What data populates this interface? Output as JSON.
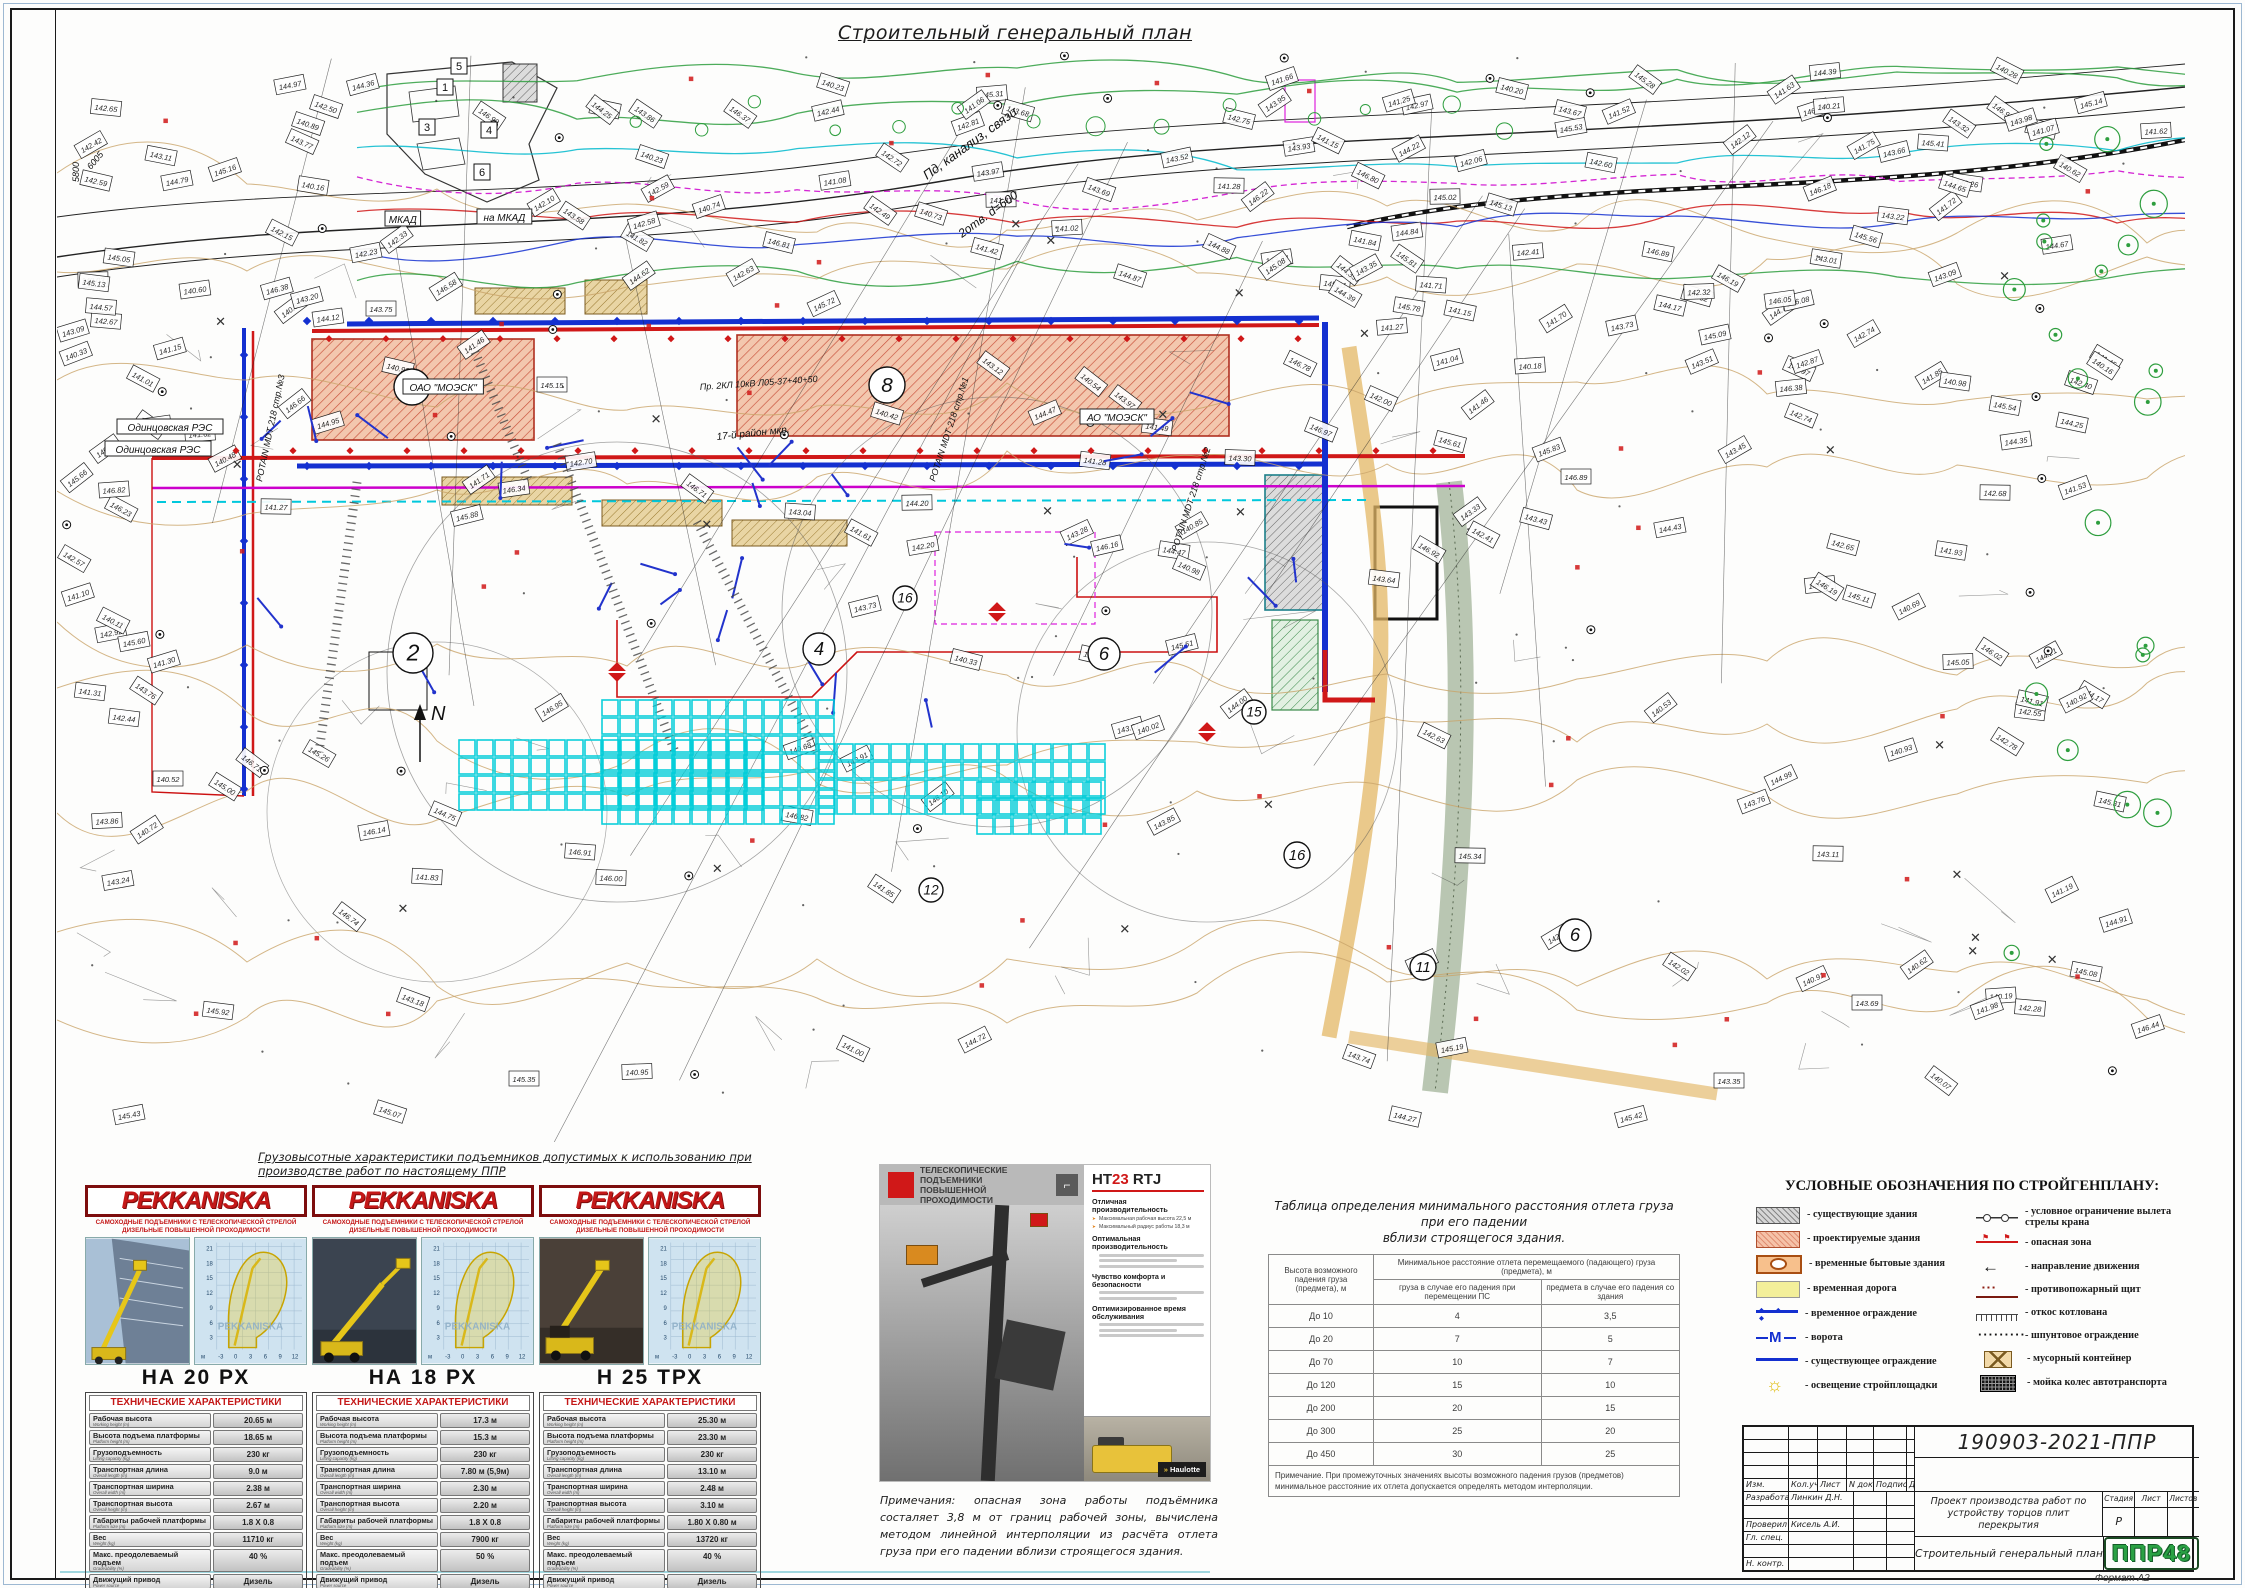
{
  "sheet": {
    "title": "Строительный генеральный план",
    "format_label": "Формат А2"
  },
  "plan": {
    "circle_labels": [
      {
        "t": "7",
        "x": 355,
        "y": 335,
        "r": 18
      },
      {
        "t": "8",
        "x": 830,
        "y": 333,
        "r": 18
      },
      {
        "t": "2",
        "x": 356,
        "y": 601,
        "r": 20
      },
      {
        "t": "4",
        "x": 762,
        "y": 597,
        "r": 16
      },
      {
        "t": "6",
        "x": 1047,
        "y": 602,
        "r": 16
      },
      {
        "t": "16",
        "x": 848,
        "y": 546,
        "r": 12
      },
      {
        "t": "15",
        "x": 1197,
        "y": 660,
        "r": 12
      },
      {
        "t": "12",
        "x": 874,
        "y": 838,
        "r": 12
      },
      {
        "t": "16",
        "x": 1240,
        "y": 803,
        "r": 13
      },
      {
        "t": "11",
        "x": 1366,
        "y": 915,
        "r": 13
      },
      {
        "t": "6",
        "x": 1518,
        "y": 883,
        "r": 16
      }
    ],
    "box_labels": [
      {
        "t": "МКАД",
        "x": 328,
        "y": 170
      },
      {
        "t": "на МКАД",
        "x": 420,
        "y": 168
      },
      {
        "t": "Одинцовская РЭС",
        "x": 60,
        "y": 378
      },
      {
        "t": "Одинцовская РЭС",
        "x": 48,
        "y": 400
      },
      {
        "t": "ОАО \"МОЭСК\"",
        "x": 346,
        "y": 338
      },
      {
        "t": "АО \"МОЭСК\"",
        "x": 1023,
        "y": 368
      }
    ],
    "diag_labels": [
      {
        "t": "Пд, канализ, связи",
        "x": 870,
        "y": 128,
        "rot": -36,
        "fs": 13
      },
      {
        "t": "2отв. d=600",
        "x": 905,
        "y": 186,
        "rot": -36,
        "fs": 12
      },
      {
        "t": "Пр. 2КЛ 10кВ Л05-37+40+50",
        "x": 643,
        "y": 338,
        "rot": -4,
        "fs": 9
      },
      {
        "t": "POTAIN MDT 218 стр.№1",
        "x": 878,
        "y": 430,
        "rot": -72,
        "fs": 9
      },
      {
        "t": "POTAIN MDT 218 стр.№2",
        "x": 1120,
        "y": 500,
        "rot": -72,
        "fs": 9
      },
      {
        "t": "POTAIN MDT 218 стр.№3",
        "x": 205,
        "y": 430,
        "rot": -78,
        "fs": 9
      },
      {
        "t": "17-й район мкр.",
        "x": 660,
        "y": 388,
        "rot": -6,
        "fs": 10
      },
      {
        "t": "5800",
        "x": 22,
        "y": 130,
        "rot": -90,
        "fs": 9
      },
      {
        "t": "6005",
        "x": 34,
        "y": 118,
        "rot": -50,
        "fs": 9
      }
    ],
    "building_numbers": [
      {
        "t": "1",
        "x": 388,
        "y": 35
      },
      {
        "t": "3",
        "x": 370,
        "y": 75
      },
      {
        "t": "4",
        "x": 432,
        "y": 78
      },
      {
        "t": "5",
        "x": 402,
        "y": 14
      },
      {
        "t": "6",
        "x": 425,
        "y": 120
      }
    ],
    "north_label": "N"
  },
  "lifts_caption": "Грузовысотные характеристики подъемников допустимых к использованию при производстве работ по настоящему ППР",
  "mini_chart": {
    "y_ticks": [
      "21",
      "18",
      "15",
      "12",
      "9",
      "6",
      "3"
    ],
    "x_ticks": [
      "-3",
      "0",
      "3",
      "6",
      "9",
      "12"
    ],
    "axis_label": "м",
    "watermark": "PEKKANISKA"
  },
  "lift_cards": [
    {
      "brand": "PEKKANISKA",
      "subtitle1": "САМОХОДНЫЕ ПОДЪЕМНИКИ С ТЕЛЕСКОПИЧЕСКОЙ СТРЕЛОЙ",
      "subtitle2": "ДИЗЕЛЬНЫЕ ПОВЫШЕННОЙ ПРОХОДИМОСТИ",
      "model": "НА 20 РХ",
      "table_title": "ТЕХНИЧЕСКИЕ ХАРАКТЕРИСТИКИ",
      "specs": [
        {
          "label": "Рабочая высота",
          "sub": "Working height (m)",
          "value": "20.65 м"
        },
        {
          "label": "Высота подъема платформы",
          "sub": "Platform height (m)",
          "value": "18.65 м"
        },
        {
          "label": "Грузоподъемность",
          "sub": "Lifting capacity (kg)",
          "value": "230 кг"
        },
        {
          "label": "Транспортная длина",
          "sub": "Overall length (m)",
          "value": "9.0 м"
        },
        {
          "label": "Транспортная ширина",
          "sub": "Overall width (m)",
          "value": "2.38 м"
        },
        {
          "label": "Транспортная высота",
          "sub": "Overall height (m)",
          "value": "2.67 м"
        },
        {
          "label": "Габариты рабочей платформы",
          "sub": "Platform size (m)",
          "value": "1.8 X 0.8"
        },
        {
          "label": "Вес",
          "sub": "Weight (kg)",
          "value": "11710 кг"
        },
        {
          "label": "Макс. преодолеваемый подъем",
          "sub": "Gradeability (%)",
          "value": "40 %"
        },
        {
          "label": "Движущий привод",
          "sub": "Power source",
          "value": "Дизель"
        }
      ]
    },
    {
      "brand": "PEKKANISKA",
      "subtitle1": "САМОХОДНЫЕ ПОДЪЕМНИКИ С ТЕЛЕСКОПИЧЕСКОЙ СТРЕЛОЙ",
      "subtitle2": "ДИЗЕЛЬНЫЕ ПОВЫШЕННОЙ ПРОХОДИМОСТИ",
      "model": "НА 18 РХ",
      "table_title": "ТЕХНИЧЕСКИЕ ХАРАКТЕРИСТИКИ",
      "specs": [
        {
          "label": "Рабочая высота",
          "sub": "Working height (m)",
          "value": "17.3 м"
        },
        {
          "label": "Высота подъема платформы",
          "sub": "Platform height (m)",
          "value": "15.3 м"
        },
        {
          "label": "Грузоподъемность",
          "sub": "Lifting capacity (kg)",
          "value": "230 кг"
        },
        {
          "label": "Транспортная длина",
          "sub": "Overall length (m)",
          "value": "7.80 м (5,9м)"
        },
        {
          "label": "Транспортная ширина",
          "sub": "Overall width (m)",
          "value": "2.30 м"
        },
        {
          "label": "Транспортная высота",
          "sub": "Overall height (m)",
          "value": "2.20 м"
        },
        {
          "label": "Габариты рабочей платформы",
          "sub": "Platform size (m)",
          "value": "1.8 X 0.8"
        },
        {
          "label": "Вес",
          "sub": "Weight (kg)",
          "value": "7900 кг"
        },
        {
          "label": "Макс. преодолеваемый подъем",
          "sub": "Gradeability (%)",
          "value": "50 %"
        },
        {
          "label": "Движущий привод",
          "sub": "Power source",
          "value": "Дизель"
        }
      ]
    },
    {
      "brand": "PEKKANISKA",
      "subtitle1": "САМОХОДНЫЕ ПОДЪЕМНИКИ С ТЕЛЕСКОПИЧЕСКОЙ СТРЕЛОЙ",
      "subtitle2": "ДИЗЕЛЬНЫЕ ПОВЫШЕННОЙ ПРОХОДИМОСТИ",
      "model": "Н 25 ТРХ",
      "table_title": "ТЕХНИЧЕСКИЕ ХАРАКТЕРИСТИКИ",
      "specs": [
        {
          "label": "Рабочая высота",
          "sub": "Working height (m)",
          "value": "25.30 м"
        },
        {
          "label": "Высота подъема платформы",
          "sub": "Platform height (m)",
          "value": "23.30 м"
        },
        {
          "label": "Грузоподъемность",
          "sub": "Lifting capacity (kg)",
          "value": "230 кг"
        },
        {
          "label": "Транспортная длина",
          "sub": "Overall length (m)",
          "value": "13.10 м"
        },
        {
          "label": "Транспортная ширина",
          "sub": "Overall width (m)",
          "value": "2.48 м"
        },
        {
          "label": "Транспортная высота",
          "sub": "Overall height (m)",
          "value": "3.10 м"
        },
        {
          "label": "Габариты рабочей платформы",
          "sub": "Platform size (m)",
          "value": "1.80 X 0.80 м"
        },
        {
          "label": "Вес",
          "sub": "Weight (kg)",
          "value": "13720 кг"
        },
        {
          "label": "Макс. преодолеваемый подъем",
          "sub": "Gradeability (%)",
          "value": "40 %"
        },
        {
          "label": "Движущий привод",
          "sub": "Power source",
          "value": "Дизель"
        }
      ]
    }
  ],
  "brochure": {
    "header_line1": "ТЕЛЕСКОПИЧЕСКИЕ ПОДЪЕМНИКИ",
    "header_line2": "ПОВЫШЕННОЙ ПРОХОДИМОСТИ",
    "model_prefix": "HT",
    "model_number": "23",
    "model_suffix": " RTJ",
    "sec1_title": "Отличная производительность",
    "sec1_bullets": [
      "Максимальная рабочая высота 22,5 м",
      "Максимальный радиус работы 18,3 м"
    ],
    "sec2_title": "Оптимальная производительность",
    "sec3_title": "Чувство комфорта и безопасности",
    "sec4_title": "Оптимизированное время обслуживания",
    "brand": "Haulotte"
  },
  "fall_table": {
    "title_line1": "Таблица определения минимального расстояния отлета груза при его падении",
    "title_line2": "вблизи строящегося здания.",
    "col1": "Высота возможного падения груза (предмета), м",
    "col2": "Минимальное расстояние отлета перемещаемого (падающего) груза (предмета), м",
    "col2a": "груза в случае его падения при перемещении ПС",
    "col2b": "предмета в случае его падения со здания",
    "rows": [
      [
        "До 10",
        "4",
        "3,5"
      ],
      [
        "До 20",
        "7",
        "5"
      ],
      [
        "До 70",
        "10",
        "7"
      ],
      [
        "До 120",
        "15",
        "10"
      ],
      [
        "До 200",
        "20",
        "15"
      ],
      [
        "До 300",
        "25",
        "20"
      ],
      [
        "До 450",
        "30",
        "25"
      ]
    ],
    "note": "Примечание. При промежуточных значениях высоты возможного падения грузов (предметов) минимальное расстояние их отлета допускается определять методом интерполяции."
  },
  "site_note": "Примечания: опасная зона работы подъёмника состаляет 3,8 м от границ рабочей зоны, вычислена методом линейной интерполяции из расчёта отлета груза при его падении вблизи строящегося здания.",
  "legend": {
    "title": "УСЛОВНЫЕ ОБОЗНАЧЕНИЯ ПО СТРОЙГЕНПЛАНУ:",
    "left": [
      {
        "icon": "existing-building",
        "label": "- существующие здания"
      },
      {
        "icon": "projected-building",
        "label": "- проектируемые здания"
      },
      {
        "icon": "temp-household",
        "label": "- временные бытовые здания"
      },
      {
        "icon": "temp-road",
        "label": "- временная дорога"
      },
      {
        "icon": "temp-fence",
        "label": "- временное ограждение"
      },
      {
        "icon": "gate",
        "label": "- ворота"
      },
      {
        "icon": "existing-fence",
        "label": "- существующее ограждение"
      },
      {
        "icon": "lighting",
        "label": "- освещение стройплощадки"
      }
    ],
    "right": [
      {
        "icon": "crane-limit",
        "label": "- условное ограничение вылета стрелы крана"
      },
      {
        "icon": "danger-zone",
        "label": "- опасная зона"
      },
      {
        "icon": "direction",
        "label": "- направление движения"
      },
      {
        "icon": "fire-shield",
        "label": "- противопожарный щит"
      },
      {
        "icon": "slope",
        "label": "- откос котлована"
      },
      {
        "icon": "sheet-pile",
        "label": "- шпунтовое ограждение"
      },
      {
        "icon": "waste-container",
        "label": "- мусорный контейнер"
      },
      {
        "icon": "wheel-wash",
        "label": "- мойка колес автотранспорта"
      }
    ]
  },
  "title_block": {
    "doc_number": "190903-2021-ППР",
    "cols": [
      "Изм.",
      "Кол.уч",
      "Лист",
      "N док",
      "Подпись",
      "Дата"
    ],
    "row_developed_label": "Разработал",
    "row_developed_value": "Линкин Д.Н.",
    "row_checked_label": "Проверил",
    "row_checked_value": "Кисель А.И.",
    "row_chief_label": "Гл. спец.",
    "row_ncontrol_label": "Н. контр.",
    "project": "Проект производства работ по устройству торцов плит перекрытия",
    "stage_label": "Стадия",
    "sheet_label": "Лист",
    "sheets_label": "Листов",
    "stage_value": "Р",
    "sheet_title": "Строительный генеральный план",
    "logo": "ППР48"
  }
}
